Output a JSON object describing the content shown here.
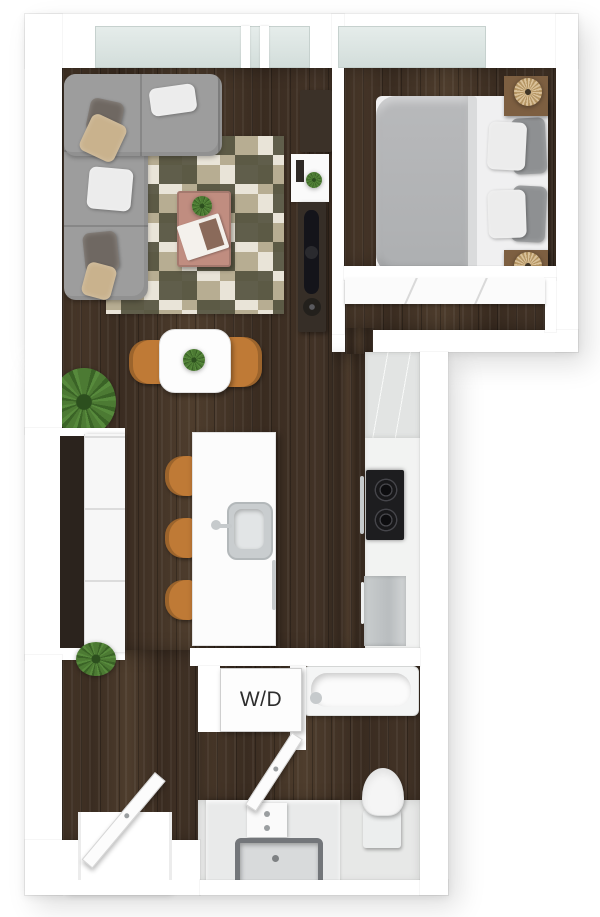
{
  "labels": {
    "washer_dryer": "W/D"
  },
  "colors": {
    "wall": "#ffffff",
    "floor_wood": "#443427",
    "glass": "#dbe4e2",
    "sofa": "#9d9d9d",
    "pillow_dark": "#6f6862",
    "pillow_tan": "#c9b28d",
    "pillow_white": "#ececec",
    "rug_cream": "#e9e4d8",
    "rug_tan": "#b7ad92",
    "rug_olive": "#55523f",
    "coffee_table": "#c08d80",
    "chair_orange": "#bf7a36",
    "bed_duvet": "#b3b5b7",
    "nightstand": "#7d5f41",
    "lamp": "#c7a56c",
    "console_dark": "#362e27",
    "cooktop": "#1d1d1f",
    "stainless": "#c6cacc",
    "plant": "#4c7a33",
    "tile": "#e7e8e7",
    "label_text": "#2d2d2d"
  },
  "inventory": {
    "rooms": [
      {
        "name": "living-room",
        "items": [
          "sectional-sofa",
          "throw-pillows",
          "patchwork-rug",
          "coffee-table",
          "magazine",
          "media-console",
          "tv",
          "wall-shelf",
          "floor-plant"
        ]
      },
      {
        "name": "dining-area",
        "items": [
          "dining-table",
          "dining-chair-left",
          "dining-chair-right",
          "centerpiece-plant"
        ]
      },
      {
        "name": "kitchen",
        "items": [
          "island",
          "island-sink",
          "faucet",
          "dishwasher-handle",
          "bar-stools",
          "upper-cabinets",
          "cooktop",
          "oven-handle",
          "refrigerator"
        ]
      },
      {
        "name": "bedroom",
        "items": [
          "double-bed",
          "duvet",
          "pillows",
          "nightstand-top",
          "nightstand-bottom",
          "rattan-lamps",
          "sliding-door-closet",
          "window"
        ]
      },
      {
        "name": "bathroom",
        "items": [
          "bathtub",
          "toilet",
          "vanity",
          "sink-basin",
          "swing-door"
        ]
      },
      {
        "name": "laundry-closet",
        "items": [
          "washer-dryer-unit"
        ]
      },
      {
        "name": "entry",
        "items": [
          "entry-door",
          "threshold",
          "wardrobe-alcove",
          "small-plant"
        ]
      }
    ]
  }
}
